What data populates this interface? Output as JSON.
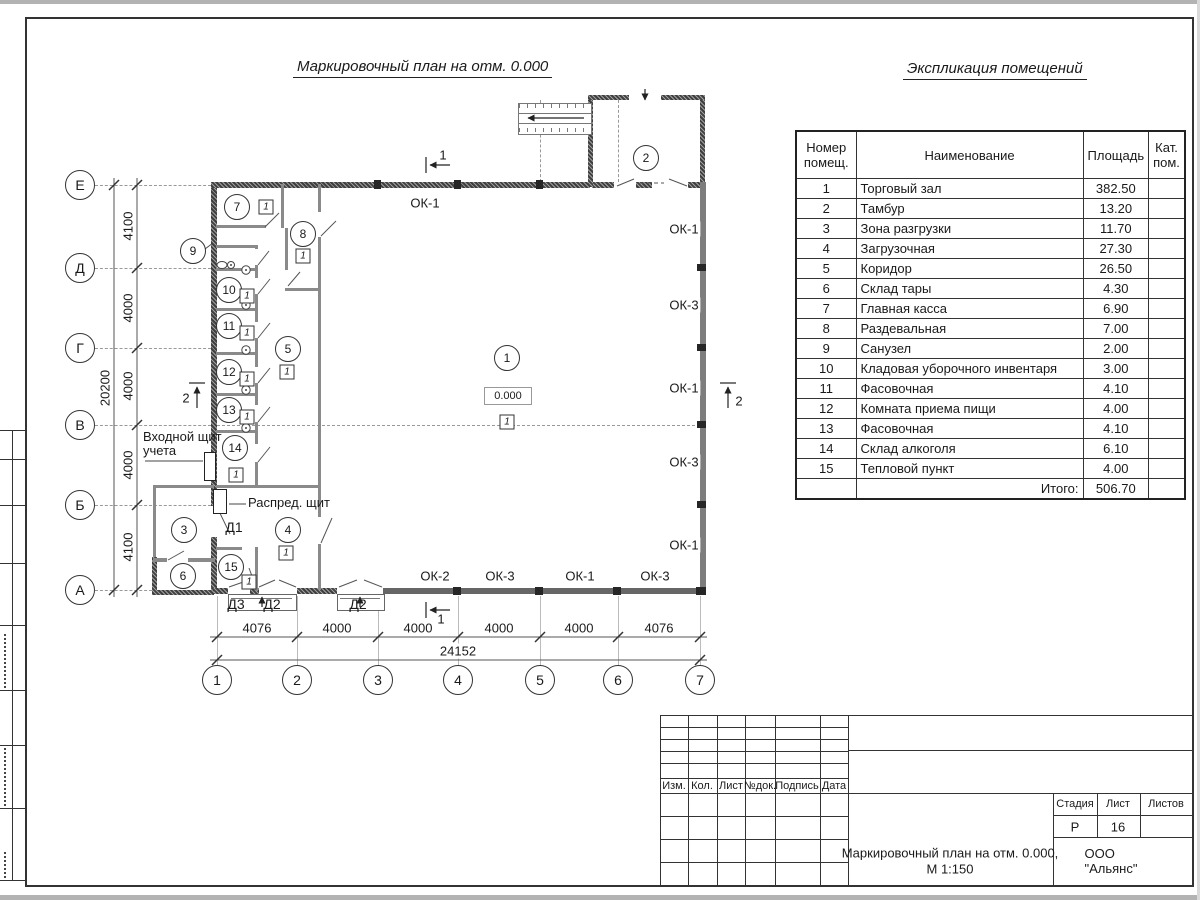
{
  "sheet": {
    "plan_title": "Маркировочный план на отм. 0.000",
    "table_title": "Экспликация помещений"
  },
  "explication": {
    "headers": {
      "num": "Номер помещ.",
      "name": "Наименование",
      "area": "Площадь",
      "cat": "Кат. пом."
    },
    "rows": [
      {
        "num": "1",
        "name": "Торговый зал",
        "area": "382.50"
      },
      {
        "num": "2",
        "name": "Тамбур",
        "area": "13.20"
      },
      {
        "num": "3",
        "name": "Зона разгрузки",
        "area": "11.70"
      },
      {
        "num": "4",
        "name": "Загрузочная",
        "area": "27.30"
      },
      {
        "num": "5",
        "name": "Коридор",
        "area": "26.50"
      },
      {
        "num": "6",
        "name": "Склад тары",
        "area": "4.30"
      },
      {
        "num": "7",
        "name": "Главная касса",
        "area": "6.90"
      },
      {
        "num": "8",
        "name": "Раздевальная",
        "area": "7.00"
      },
      {
        "num": "9",
        "name": "Санузел",
        "area": "2.00"
      },
      {
        "num": "10",
        "name": "Кладовая уборочного инвентаря",
        "area": "3.00"
      },
      {
        "num": "11",
        "name": "Фасовочная",
        "area": "4.10"
      },
      {
        "num": "12",
        "name": "Комната приема пищи",
        "area": "4.00"
      },
      {
        "num": "13",
        "name": "Фасовочная",
        "area": "4.10"
      },
      {
        "num": "14",
        "name": "Склад алкоголя",
        "area": "6.10"
      },
      {
        "num": "15",
        "name": "Тепловой пункт",
        "area": "4.00"
      }
    ],
    "total_label": "Итого:",
    "total_value": "506.70"
  },
  "axes": {
    "cols": [
      {
        "v": "1",
        "x": 217,
        "y": 680
      },
      {
        "v": "2",
        "x": 297,
        "y": 680
      },
      {
        "v": "3",
        "x": 378,
        "y": 680
      },
      {
        "v": "4",
        "x": 458,
        "y": 680
      },
      {
        "v": "5",
        "x": 540,
        "y": 680
      },
      {
        "v": "6",
        "x": 618,
        "y": 680
      },
      {
        "v": "7",
        "x": 700,
        "y": 680
      }
    ],
    "rows": [
      {
        "v": "Е",
        "x": 80,
        "y": 185
      },
      {
        "v": "Д",
        "x": 80,
        "y": 268
      },
      {
        "v": "Г",
        "x": 80,
        "y": 348
      },
      {
        "v": "В",
        "x": 80,
        "y": 425
      },
      {
        "v": "Б",
        "x": 80,
        "y": 505
      },
      {
        "v": "А",
        "x": 80,
        "y": 590
      }
    ]
  },
  "dims": {
    "bottom": [
      {
        "v": "4076",
        "x": 257,
        "y": 628
      },
      {
        "v": "4000",
        "x": 337,
        "y": 628
      },
      {
        "v": "4000",
        "x": 418,
        "y": 628
      },
      {
        "v": "4000",
        "x": 499,
        "y": 628
      },
      {
        "v": "4000",
        "x": 579,
        "y": 628
      },
      {
        "v": "4076",
        "x": 659,
        "y": 628
      }
    ],
    "bottom_total": {
      "v": "24152",
      "x": 458,
      "y": 651
    },
    "left": [
      {
        "v": "4100",
        "x": 128,
        "y": 226
      },
      {
        "v": "4000",
        "x": 128,
        "y": 308
      },
      {
        "v": "4000",
        "x": 128,
        "y": 386
      },
      {
        "v": "4000",
        "x": 128,
        "y": 465
      },
      {
        "v": "4100",
        "x": 128,
        "y": 547
      }
    ],
    "left_total": {
      "v": "20200",
      "x": 105,
      "y": 388
    }
  },
  "rooms": [
    {
      "v": "1",
      "x": 507,
      "y": 358
    },
    {
      "v": "2",
      "x": 646,
      "y": 158
    },
    {
      "v": "3",
      "x": 184,
      "y": 530
    },
    {
      "v": "4",
      "x": 288,
      "y": 530
    },
    {
      "v": "5",
      "x": 288,
      "y": 349
    },
    {
      "v": "6",
      "x": 183,
      "y": 576
    },
    {
      "v": "7",
      "x": 237,
      "y": 207
    },
    {
      "v": "8",
      "x": 303,
      "y": 234
    },
    {
      "v": "9",
      "x": 193,
      "y": 251
    },
    {
      "v": "10",
      "x": 229,
      "y": 290
    },
    {
      "v": "11",
      "x": 229,
      "y": 326
    },
    {
      "v": "12",
      "x": 229,
      "y": 372
    },
    {
      "v": "13",
      "x": 229,
      "y": 410
    },
    {
      "v": "14",
      "x": 235,
      "y": 448
    },
    {
      "v": "15",
      "x": 231,
      "y": 567
    }
  ],
  "floor_tags": [
    {
      "v": "1",
      "x": 266,
      "y": 207
    },
    {
      "v": "1",
      "x": 303,
      "y": 256
    },
    {
      "v": "1",
      "x": 287,
      "y": 372
    },
    {
      "v": "1",
      "x": 507,
      "y": 422
    },
    {
      "v": "1",
      "x": 247,
      "y": 296
    },
    {
      "v": "1",
      "x": 247,
      "y": 333
    },
    {
      "v": "1",
      "x": 247,
      "y": 379
    },
    {
      "v": "1",
      "x": 247,
      "y": 417
    },
    {
      "v": "1",
      "x": 236,
      "y": 475
    },
    {
      "v": "1",
      "x": 249,
      "y": 582
    },
    {
      "v": "1",
      "x": 286,
      "y": 553
    }
  ],
  "windows": [
    {
      "v": "ОК-1",
      "x": 425,
      "y": 203
    },
    {
      "v": "ОК-1",
      "x": 684,
      "y": 229
    },
    {
      "v": "ОК-3",
      "x": 684,
      "y": 305
    },
    {
      "v": "ОК-1",
      "x": 684,
      "y": 388
    },
    {
      "v": "ОК-3",
      "x": 684,
      "y": 462
    },
    {
      "v": "ОК-1",
      "x": 684,
      "y": 545
    },
    {
      "v": "ОК-2",
      "x": 435,
      "y": 576
    },
    {
      "v": "ОК-3",
      "x": 500,
      "y": 576
    },
    {
      "v": "ОК-1",
      "x": 580,
      "y": 576
    },
    {
      "v": "ОК-3",
      "x": 655,
      "y": 576
    }
  ],
  "doors": [
    {
      "v": "Д1",
      "x": 234,
      "y": 527
    },
    {
      "v": "Д3",
      "x": 236,
      "y": 604
    },
    {
      "v": "Д2",
      "x": 272,
      "y": 604
    },
    {
      "v": "Д2",
      "x": 358,
      "y": 604
    }
  ],
  "sections": [
    {
      "v": "1",
      "x": 443,
      "y": 155
    },
    {
      "v": "1",
      "x": 441,
      "y": 619
    },
    {
      "v": "2",
      "x": 186,
      "y": 398
    },
    {
      "v": "2",
      "x": 739,
      "y": 401
    }
  ],
  "notes": {
    "entry_line1": "Входной щит",
    "entry_line2": "учета",
    "dist_panel": "Распред. щит",
    "elevation": "0.000"
  },
  "title_block": {
    "rev_headers": [
      {
        "v": "Изм.",
        "x": 674,
        "y": 786
      },
      {
        "v": "Кол.",
        "x": 702,
        "y": 786
      },
      {
        "v": "Лист",
        "x": 731,
        "y": 786
      },
      {
        "v": "№док.",
        "x": 760,
        "y": 786
      },
      {
        "v": "Подпись",
        "x": 797,
        "y": 786
      },
      {
        "v": "Дата",
        "x": 834,
        "y": 786
      }
    ],
    "stage_label": "Стадия",
    "sheet_label": "Лист",
    "sheets_label": "Листов",
    "stage_value": "Р",
    "sheet_value": "16",
    "doc_title_line1": "Маркировочный план на отм. 0.000,",
    "doc_title_line2": "М 1:150",
    "company": "ООО \"Альянс\""
  }
}
